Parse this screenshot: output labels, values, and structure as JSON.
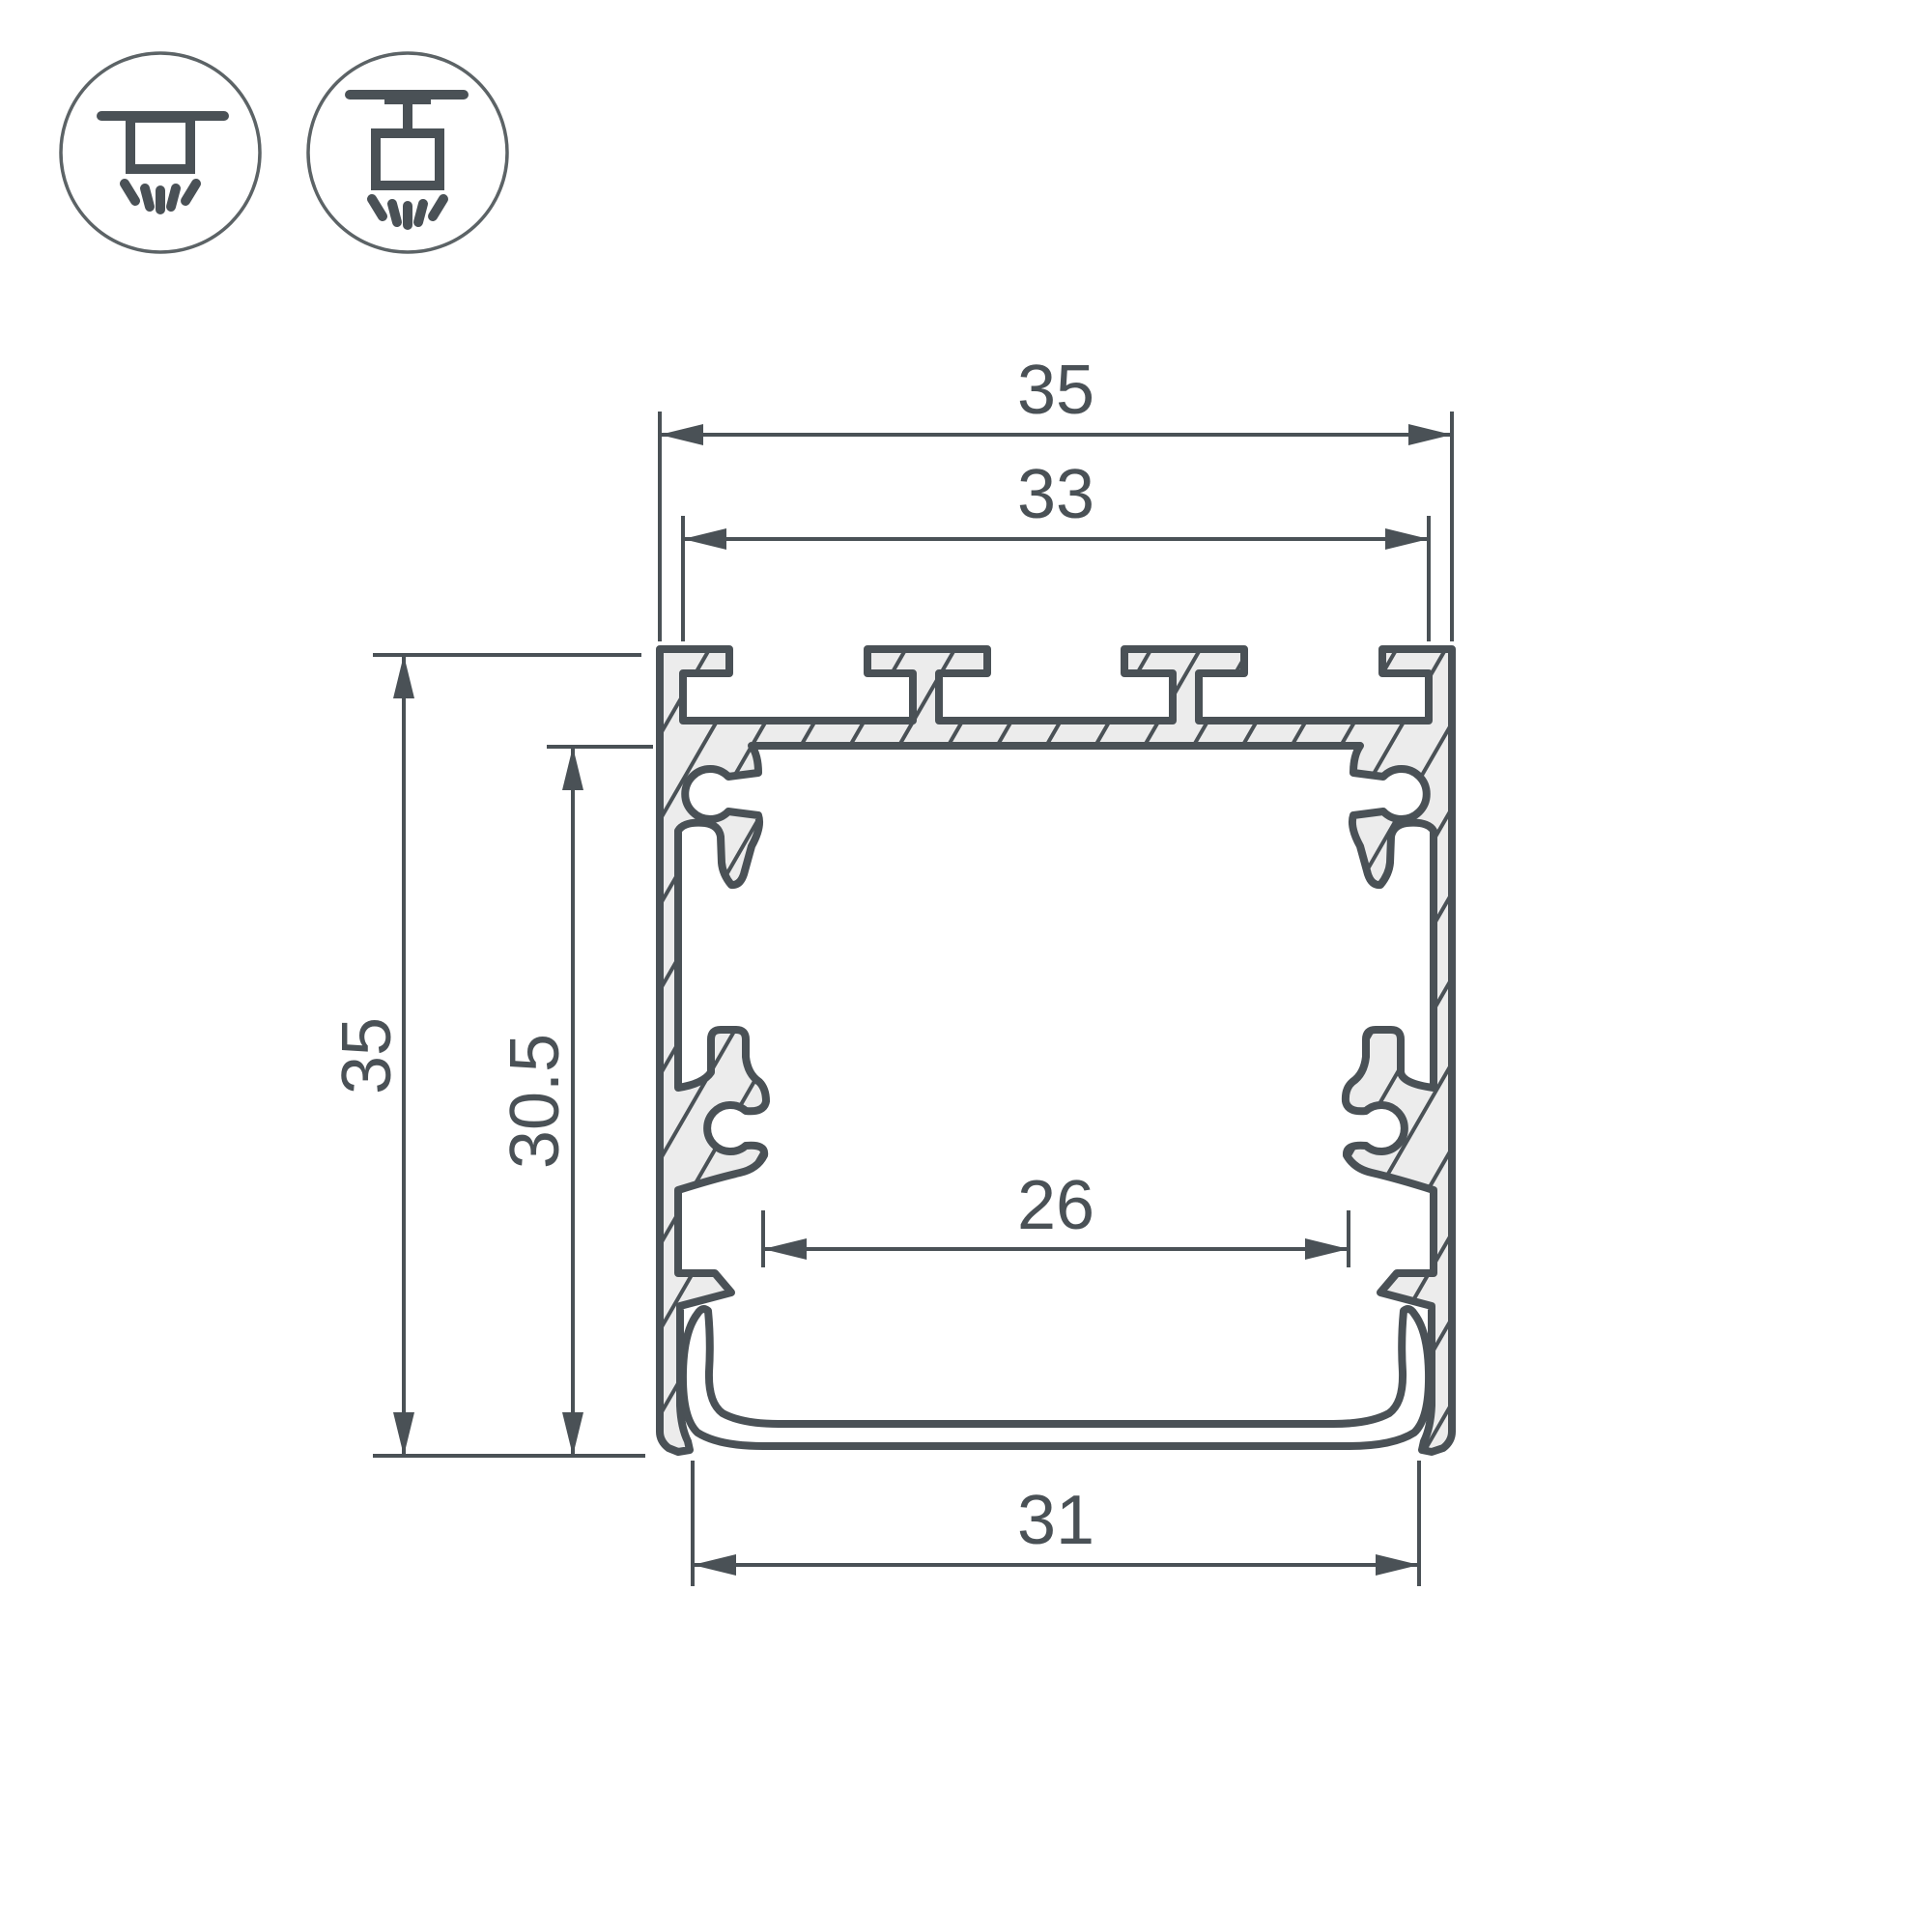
{
  "drawing": {
    "kind": "profile-cross-section-dimension-drawing",
    "dimensions": {
      "outer_width": {
        "value": "35"
      },
      "top_slot_width": {
        "value": "33"
      },
      "outer_height": {
        "value": "35"
      },
      "inner_height": {
        "value": "30.5"
      },
      "inner_cavity_width": {
        "value": "26"
      },
      "bottom_width": {
        "value": "31"
      }
    },
    "icons": [
      {
        "name": "surface-mount-luminaire-icon"
      },
      {
        "name": "pendant-mount-luminaire-icon"
      }
    ],
    "colors": {
      "line": "#4a5156",
      "material_fill": "#ececec",
      "background": "#ffffff"
    }
  }
}
